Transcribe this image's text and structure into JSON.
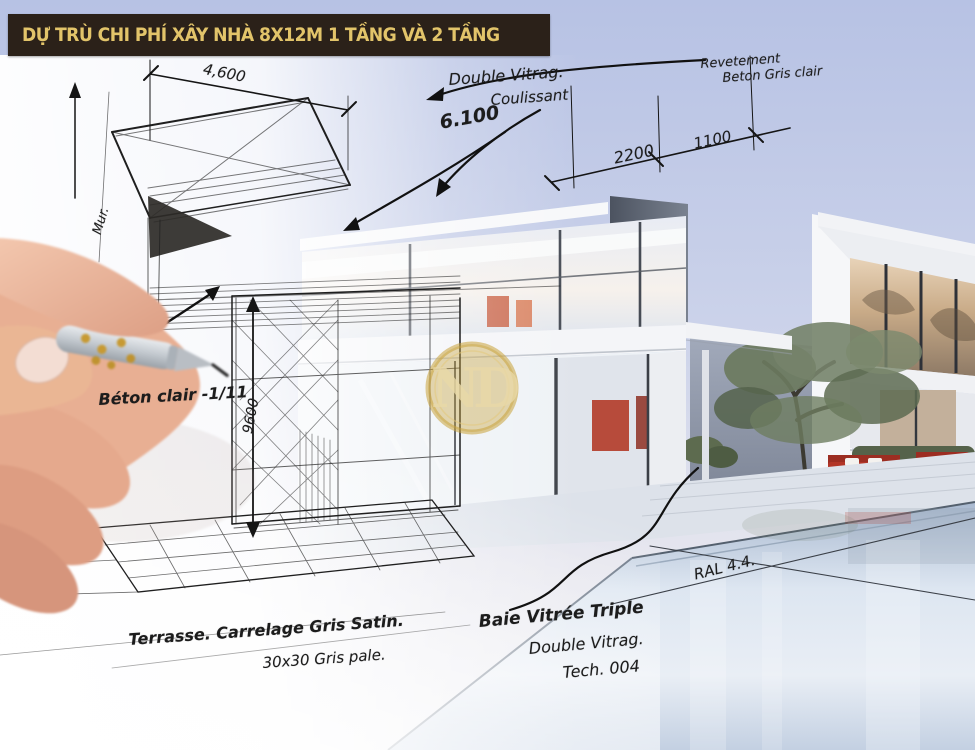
{
  "banner": {
    "title": "DỰ TRÙ CHI PHÍ XÂY NHÀ 8X12M 1 TẦNG VÀ 2 TẦNG"
  },
  "logo": {
    "monogram": "ND"
  },
  "annotations": {
    "dim_top_left": "4,600",
    "wall_label": "Mur.",
    "glazing_top_line1": "Double Vitrag.",
    "glazing_top_line2": "Coulissant",
    "dim_width": "6.100",
    "cladding_line1": "Revetement",
    "cladding_line2": "Beton Gris clair",
    "dim_2200": "2200",
    "dim_1100": "1100",
    "dim_height": "9600",
    "concrete_note": "Béton clair -1/11",
    "terrace_note_line1": "Terrasse. Carrelage Gris Satin.",
    "terrace_note_line2": "30x30 Gris pale.",
    "window_note_line1": "Baie Vitrée Triple",
    "window_note_line2": "Double Vitrag.",
    "window_note_line3": "Tech. 004",
    "pool_color_note": "RAL 4.4."
  },
  "colors": {
    "banner_bg": "#2b2119",
    "banner_text": "#e2c46a",
    "ink": "#1c1c1c",
    "logo_gold": "#c9a23b",
    "sofa_red": "#b23527",
    "sky_top": "#b7c2e4",
    "pool": "#c5d2e2"
  }
}
